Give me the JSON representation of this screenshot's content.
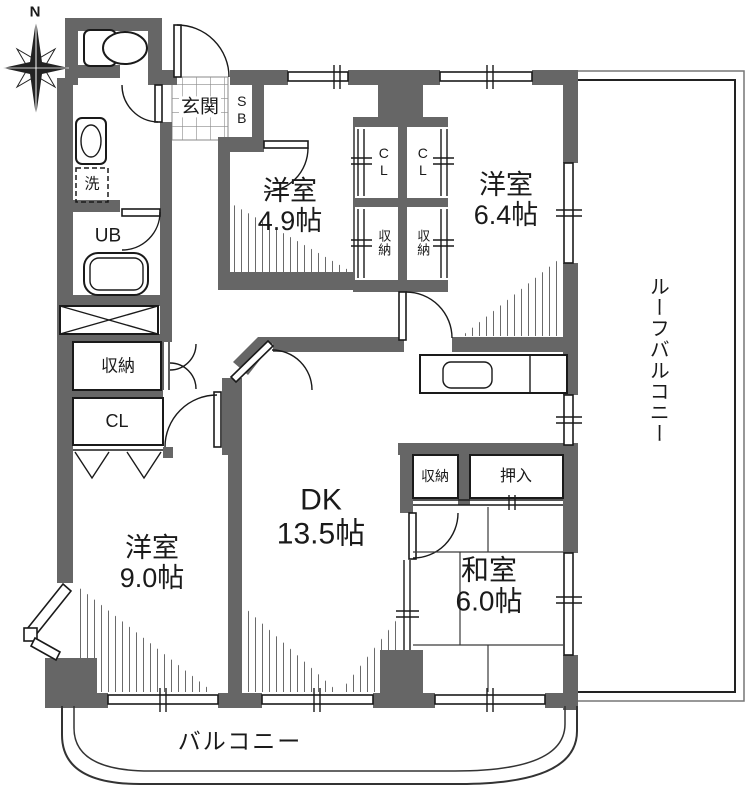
{
  "title": "マンション間取り図",
  "compass": {
    "north": "N"
  },
  "rooms": {
    "western_49": {
      "name": "洋室",
      "size": "4.9帖"
    },
    "western_64": {
      "name": "洋室",
      "size": "6.4帖"
    },
    "western_90": {
      "name": "洋室",
      "size": "9.0帖"
    },
    "dk": {
      "name": "DK",
      "size": "13.5帖"
    },
    "washitsu": {
      "name": "和室",
      "size": "6.0帖"
    }
  },
  "labels": {
    "entrance": "玄関",
    "shoe_box": "SB",
    "closet": "CL",
    "storage": "収納",
    "oshiire": "押入",
    "unit_bath": "UB",
    "laundry": "洗",
    "balcony": "バルコニー",
    "roof_balcony": "ルーフバルコニー"
  },
  "icons": {
    "compass": "compass-rose",
    "toilet": "toilet",
    "washbasin": "washbasin",
    "bathtub": "bathtub",
    "kitchen_sink": "kitchen-sink"
  },
  "colors": {
    "wall": "#666666",
    "line": "#1a1a1a",
    "floor": "#ffffff"
  }
}
